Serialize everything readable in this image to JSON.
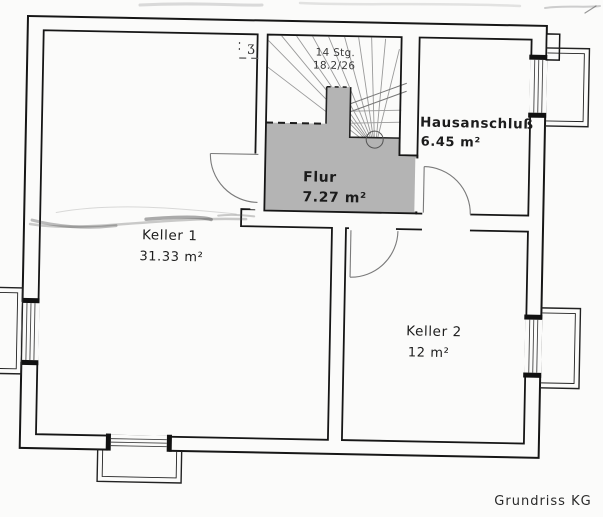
{
  "title": "Grundriss KG",
  "rooms": {
    "keller1": {
      "name": "Keller 1",
      "area": "31.33 m²"
    },
    "flur": {
      "name": "Flur",
      "area": "7.27 m²"
    },
    "hausanschluss": {
      "name": "Hausanschluß",
      "area": "6.45 m²"
    },
    "keller2": {
      "name": "Keller 2",
      "area": "12 m²"
    }
  },
  "stairs": {
    "count_label": "14 Stg.",
    "dimension_label": "18.2/26"
  },
  "corner_mark": "ʒ",
  "colors": {
    "paper": "#fbfbfa",
    "ink": "#1a1a1a",
    "flur_fill": "#b4b4b4",
    "stair_line": "#9a9a9a",
    "door_line": "#7a7a7a"
  }
}
